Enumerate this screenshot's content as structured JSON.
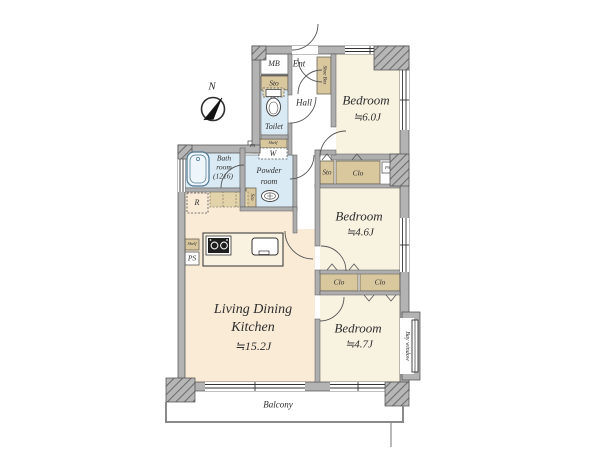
{
  "compass": {
    "north_label": "N"
  },
  "rooms": {
    "ldk": {
      "line1": "Living Dining",
      "line2": "Kitchen",
      "size": "≒15.2J"
    },
    "bedroom_top": {
      "name": "Bedroom",
      "size": "≒6.0J"
    },
    "bedroom_mid": {
      "name": "Bedroom",
      "size": "≒4.6J"
    },
    "bedroom_bottom": {
      "name": "Bedroom",
      "size": "≒4.7J"
    },
    "bathroom": {
      "line1": "Bath",
      "line2": "room",
      "line3": "(1216)"
    },
    "powder_room": {
      "line1": "Powder",
      "line2": "room"
    },
    "toilet": {
      "label": "Toilet"
    },
    "hall": {
      "label": "Hall"
    },
    "entrance": {
      "label": "Ent"
    }
  },
  "storage": {
    "meter_box": "MB",
    "sto_entry": "Sto",
    "shoe_box": "Shoe Box",
    "shelf_laundry": "Shelf",
    "washer": "W",
    "ps_bath": "PS",
    "sto_powder": "Sto",
    "refrigerator": "R",
    "shelf_kitchen": "Shelf",
    "ps_kitchen": "PS",
    "sto_bedroom_mid": "Sto",
    "clo_bedroom_mid": "Clo",
    "ps_bedroom_mid": "PS",
    "clo_bottom_left": "Clo",
    "clo_bottom_right": "Clo"
  },
  "exterior": {
    "balcony": "Balcony",
    "bay_window": "Bay window"
  },
  "colors": {
    "bedroom_floor": "#f8f2e1",
    "ldk_floor": "#f9ebd6",
    "wet_area": "#d9eaf4",
    "closet_tan": "#d9c79e",
    "wall_gray": "#b3b3b3",
    "outline": "#4a4a4a"
  }
}
